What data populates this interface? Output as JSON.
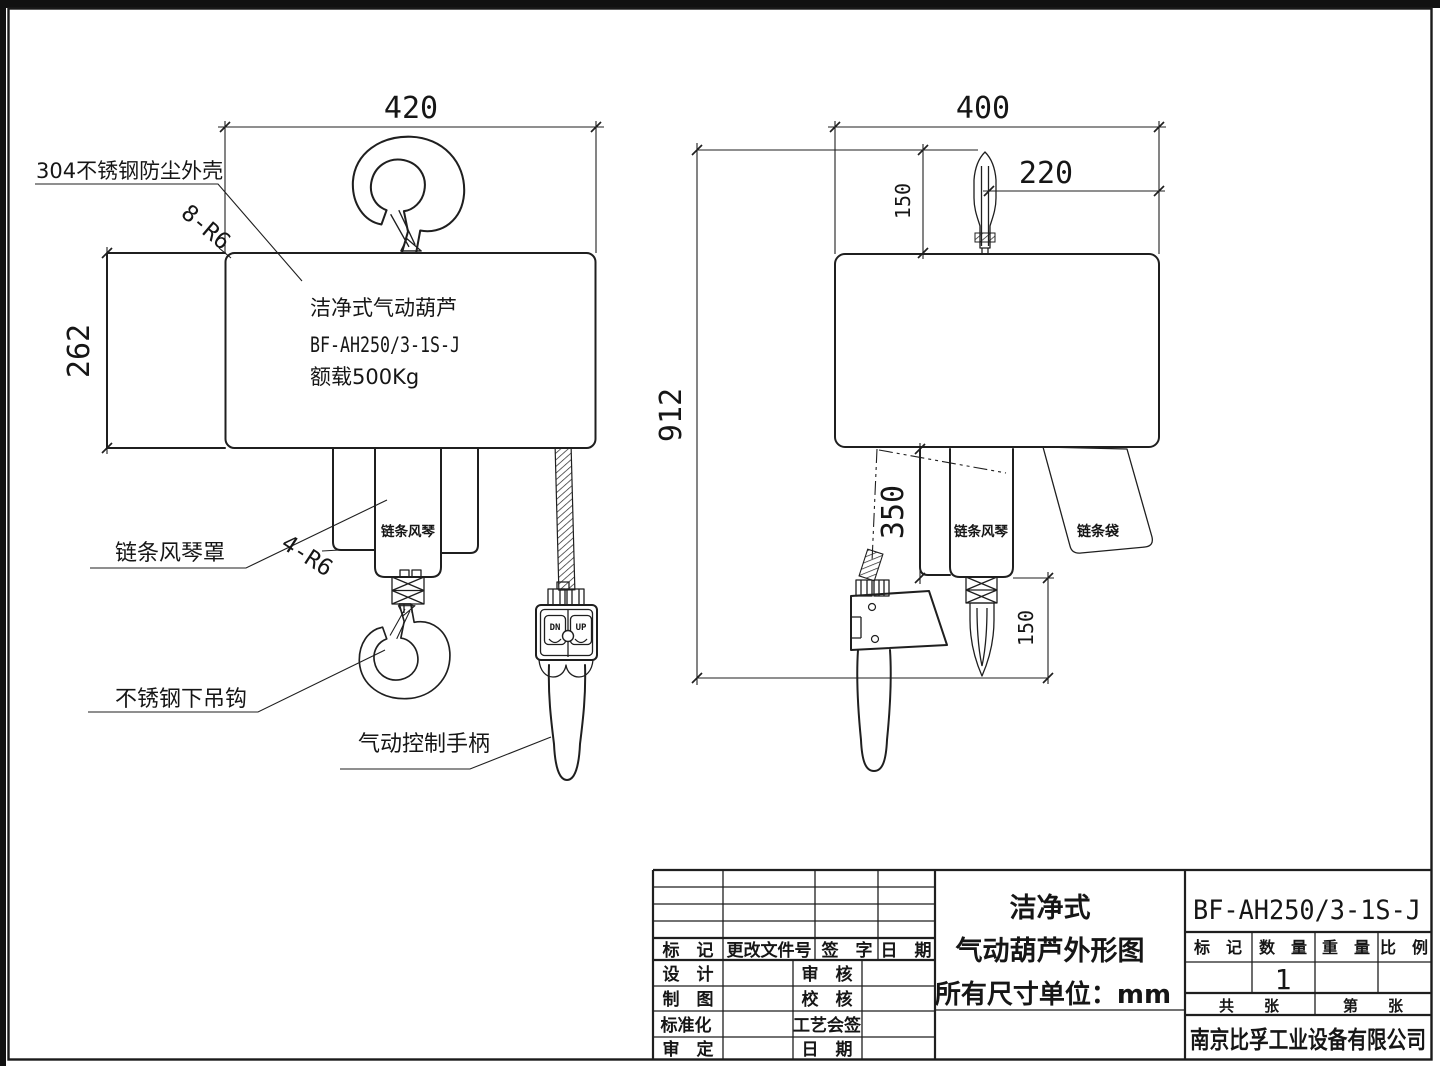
{
  "front": {
    "dim_width": "420",
    "dim_height": "262",
    "corner_note": "8-R6",
    "bellows_note": "4-R6",
    "body_line1": "洁净式气动葫芦",
    "body_line2": "BF-AH250/3-1S-J",
    "body_line3": "额载500Kg",
    "bellows_label": "链条风琴"
  },
  "side": {
    "dim_width": "400",
    "dim_top_hook": "150",
    "dim_hook_offset": "220",
    "dim_total": "912",
    "dim_headroom": "350",
    "dim_bottom_hook": "150",
    "bellows_label": "链条风琴",
    "chain_bag_label": "链条袋"
  },
  "callouts": {
    "housing": "304不锈钢防尘外壳",
    "bellows_cover": "链条风琴罩",
    "lower_hook": "不锈钢下吊钩",
    "handle": "气动控制手柄"
  },
  "pendant": {
    "down_label": "DN",
    "up_label": "UP"
  },
  "titleblock": {
    "rev_mark": "标　记",
    "rev_doc_no": "更改文件号",
    "rev_sign": "签　字",
    "rev_date": "日　期",
    "design": "设　计",
    "review": "审　核",
    "draft": "制　图",
    "proof": "校　核",
    "standardize": "标准化",
    "process_sign": "工艺会签",
    "approve": "审　定",
    "date": "日　期",
    "title_line1": "洁净式",
    "title_line2": "气动葫芦外形图",
    "title_line3": "所有尺寸单位：mm",
    "model": "BF-AH250/3-1S-J",
    "col_mark": "标　记",
    "col_qty": "数　量",
    "col_weight": "重　量",
    "col_scale": "比　例",
    "qty_value": "1",
    "sheets_total": "共　　张",
    "sheet_no": "第　　张",
    "company": "南京比孚工业设备有限公司"
  }
}
